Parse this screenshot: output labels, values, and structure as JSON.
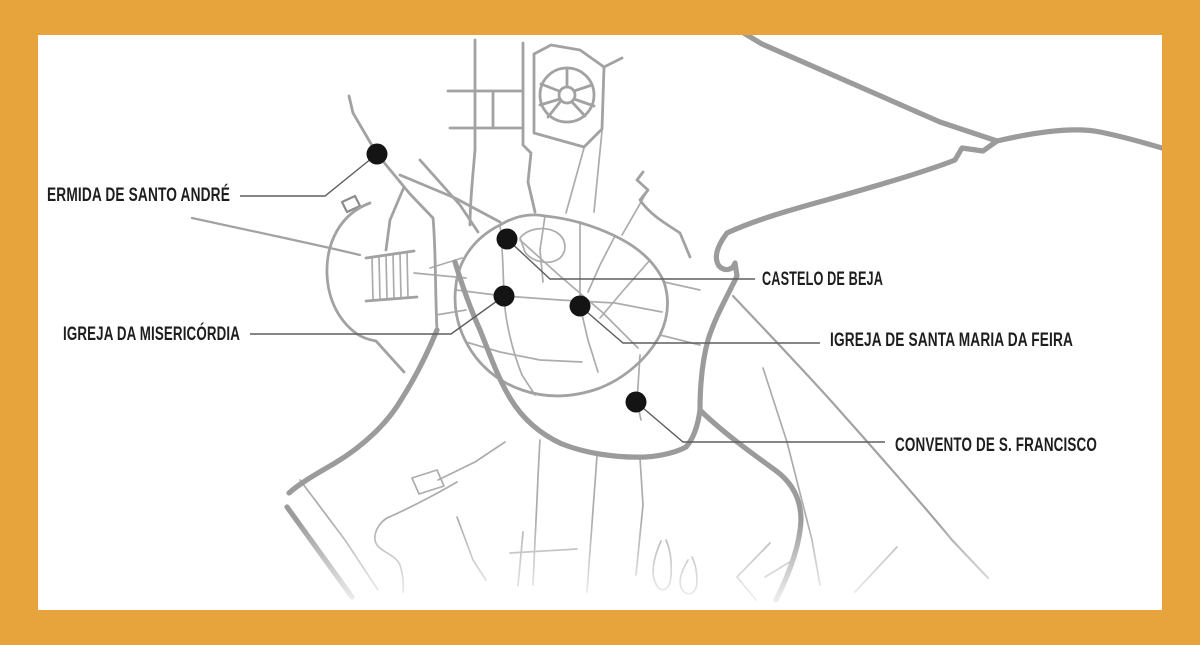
{
  "frame": {
    "border_color": "#E7A33C",
    "map_background": "#FFFFFF"
  },
  "colors": {
    "road_major": "#9B9B9B",
    "road_medium": "#A2A2A2",
    "road_minor": "#ACACAC",
    "leader_line": "#5E5E5E",
    "poi_dot": "#141414",
    "label_text": "#1E1E1E"
  },
  "map": {
    "type": "monument-location-map",
    "pois": [
      {
        "id": "ermida-de-santo-andre",
        "label": "ERMIDA DE SANTO ANDRÉ",
        "dot": {
          "x": 377,
          "y": 154
        },
        "label_side": "left"
      },
      {
        "id": "castelo-de-beja",
        "label": "CASTELO DE BEJA",
        "dot": {
          "x": 507,
          "y": 239
        },
        "label_side": "right"
      },
      {
        "id": "igreja-da-misericordia",
        "label": "IGREJA DA MISERICÓRDIA",
        "dot": {
          "x": 504,
          "y": 296
        },
        "label_side": "left"
      },
      {
        "id": "igreja-de-santa-maria-da-feira",
        "label": "IGREJA DE SANTA MARIA DA FEIRA",
        "dot": {
          "x": 580,
          "y": 306
        },
        "label_side": "right"
      },
      {
        "id": "convento-de-s-francisco",
        "label": "CONVENTO DE S. FRANCISCO",
        "dot": {
          "x": 636,
          "y": 402
        },
        "label_side": "right"
      }
    ]
  }
}
